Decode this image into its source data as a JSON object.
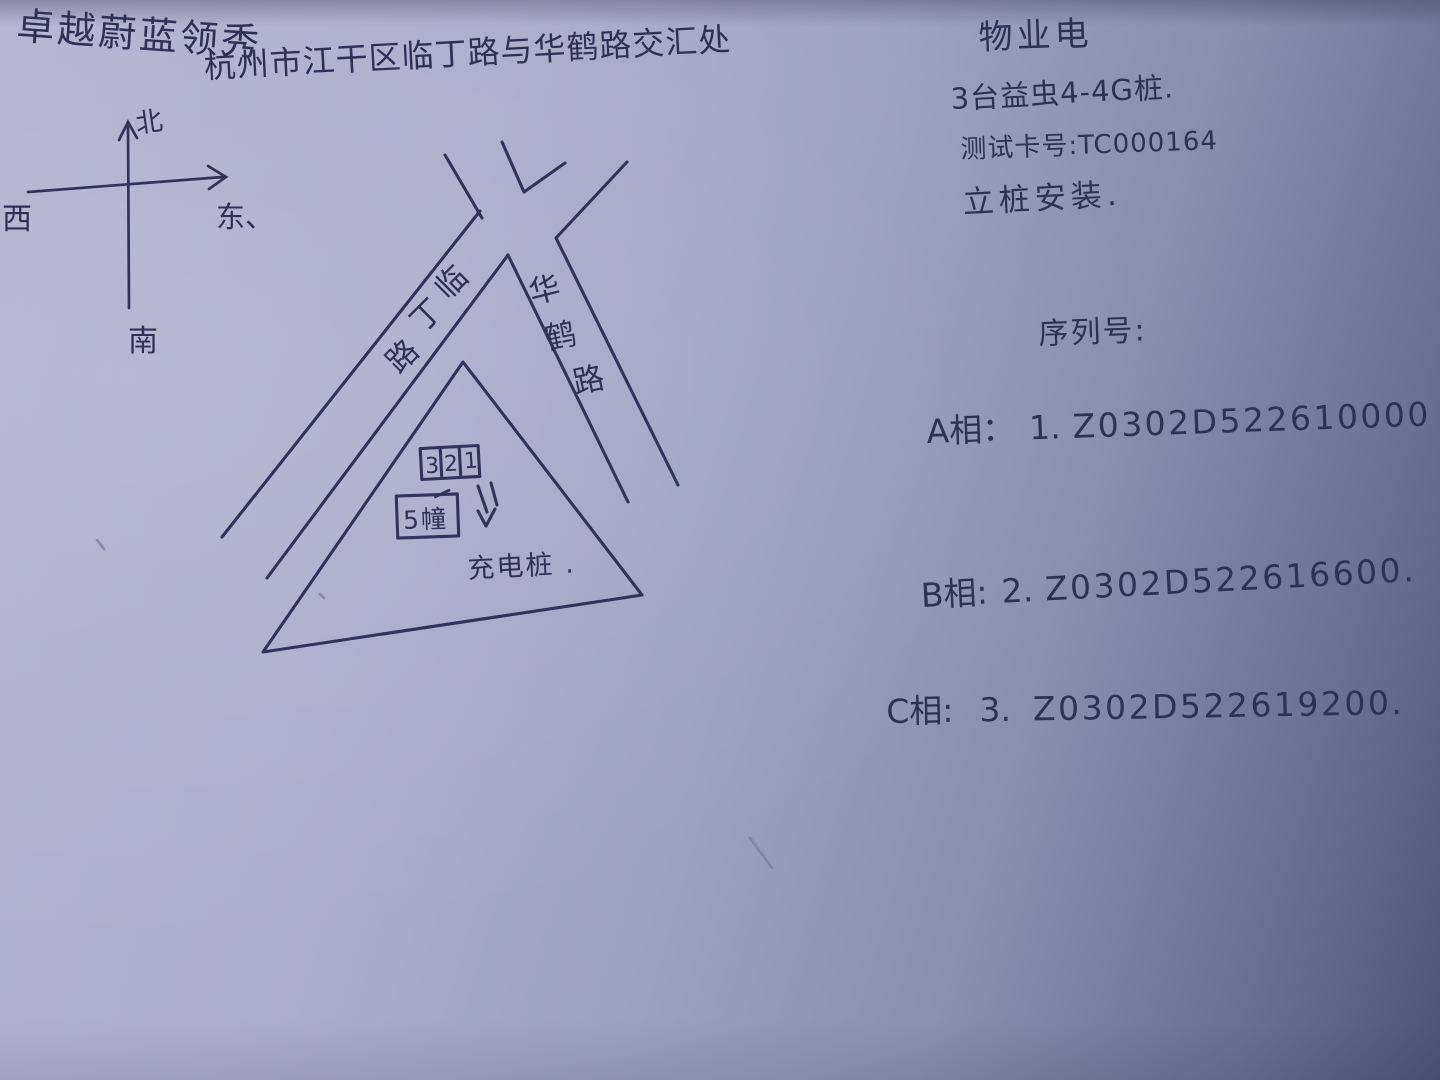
{
  "photo": {
    "paper_color": "#a9acc9",
    "paper_shadow_color": "#535878",
    "ink_color": "#2e3156"
  },
  "header": {
    "title": "卓越蔚蓝领秀",
    "address": "杭州市江干区临丁路与华鹤路交汇处"
  },
  "compass": {
    "north_label": "北",
    "south_label": "南",
    "east_label": "东、",
    "west_label": "西"
  },
  "map": {
    "left_road_chars": [
      "临",
      "丁",
      "路"
    ],
    "right_road_chars": [
      "华",
      "鹤",
      "路"
    ],
    "units_box_cells": [
      "3",
      "2",
      "1"
    ],
    "building_box_label": "5幢",
    "charging_pile_label": "充电桩 ."
  },
  "notes": {
    "heading": "物业电",
    "pile_model_line": "3台益虫4-4G桩.",
    "test_card_line": "测试卡号:TC000164",
    "install_line": "立桩安装.",
    "serial_heading": "序列号:",
    "serials": [
      {
        "phase": "A相：",
        "index": "1.",
        "value": "Z0302D522610000"
      },
      {
        "phase": "B相:",
        "index": "2.",
        "value": "Z0302D522616600."
      },
      {
        "phase": "C相:",
        "index": "3.",
        "value": "Z0302D522619200."
      }
    ]
  }
}
